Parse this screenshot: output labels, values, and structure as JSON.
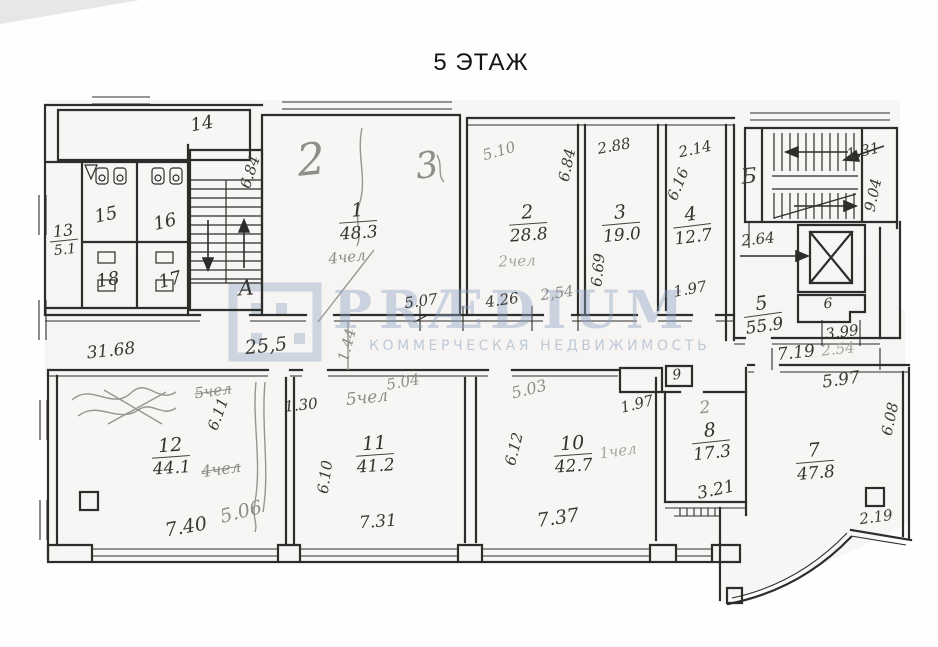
{
  "title": "5 ЭТАЖ",
  "watermark": {
    "brand": "PRÆDIUM",
    "tagline": "КОММЕРЧЕСКАЯ НЕДВИЖИМОСТЬ",
    "color": "#8ba2c0"
  },
  "stairwells": {
    "a": "А",
    "b": "Б"
  },
  "rooms": {
    "r1": {
      "number": "1",
      "area": "48.3"
    },
    "r2": {
      "number": "2",
      "area": "28.8"
    },
    "r3": {
      "number": "3",
      "area": "19.0"
    },
    "r4": {
      "number": "4",
      "area": "12.7"
    },
    "r5": {
      "number": "5",
      "area": "55.9"
    },
    "r6": {
      "number": "6"
    },
    "r7": {
      "number": "7",
      "area": "47.8"
    },
    "r8": {
      "number": "8",
      "area": "17.3"
    },
    "r9": {
      "number": "9"
    },
    "r10": {
      "number": "10",
      "area": "42.7"
    },
    "r11": {
      "number": "11",
      "area": "41.2"
    },
    "r12": {
      "number": "12",
      "area": "44.1"
    },
    "r13": {
      "number": "13",
      "area": "5.1"
    },
    "r14": {
      "number": "14"
    },
    "r15": {
      "number": "15"
    },
    "r16": {
      "number": "16"
    },
    "r17": {
      "number": "17"
    },
    "r18": {
      "number": "18"
    }
  },
  "dimensions": {
    "corridor_length_left": "31.68",
    "corridor_length_mid": "25,5",
    "room1_width": "5.07",
    "room2_width": "4.26",
    "room2_depth": "6.84",
    "room3_top": "2.88",
    "room3_depth": "6.69",
    "room4_top": "2.14",
    "room4_depth": "6.16",
    "room4_door": "1.97",
    "stair_a_depth": "6.84",
    "stair_b_top": "1.31",
    "stair_b_depth": "9.04",
    "lift_hall": "2.64",
    "room6_width": "3.99",
    "hall_right": "7.19",
    "room7_top": "5.97",
    "room7_depth": "6.08",
    "room7_corner": "2.19",
    "room8_bottom": "3.21",
    "room9_width": "1.97",
    "room10_width": "7.37",
    "room10_depth": "6.12",
    "room11_width": "7.31",
    "room11_depth": "6.10",
    "room11_left": "1.30",
    "room12_width": "7.40",
    "room12_depth": "6.11"
  },
  "pencil_notes": {
    "room1_mark": "2",
    "room1_mark2": "3",
    "room1_people": "4чел",
    "room2_width_alt": "5.10",
    "room2_people": "2чел",
    "corridor_door": "2,54",
    "corridor_tick": "1.44",
    "hall_door": "2.54",
    "room12_people_top": "5чел",
    "room12_people": "4чел",
    "room12_width_alt": "5.06",
    "room11_people": "5чел",
    "room11_width_alt": "5.04",
    "room10_width_alt": "5.03",
    "room10_people": "1чел",
    "room8_mark": "2"
  }
}
